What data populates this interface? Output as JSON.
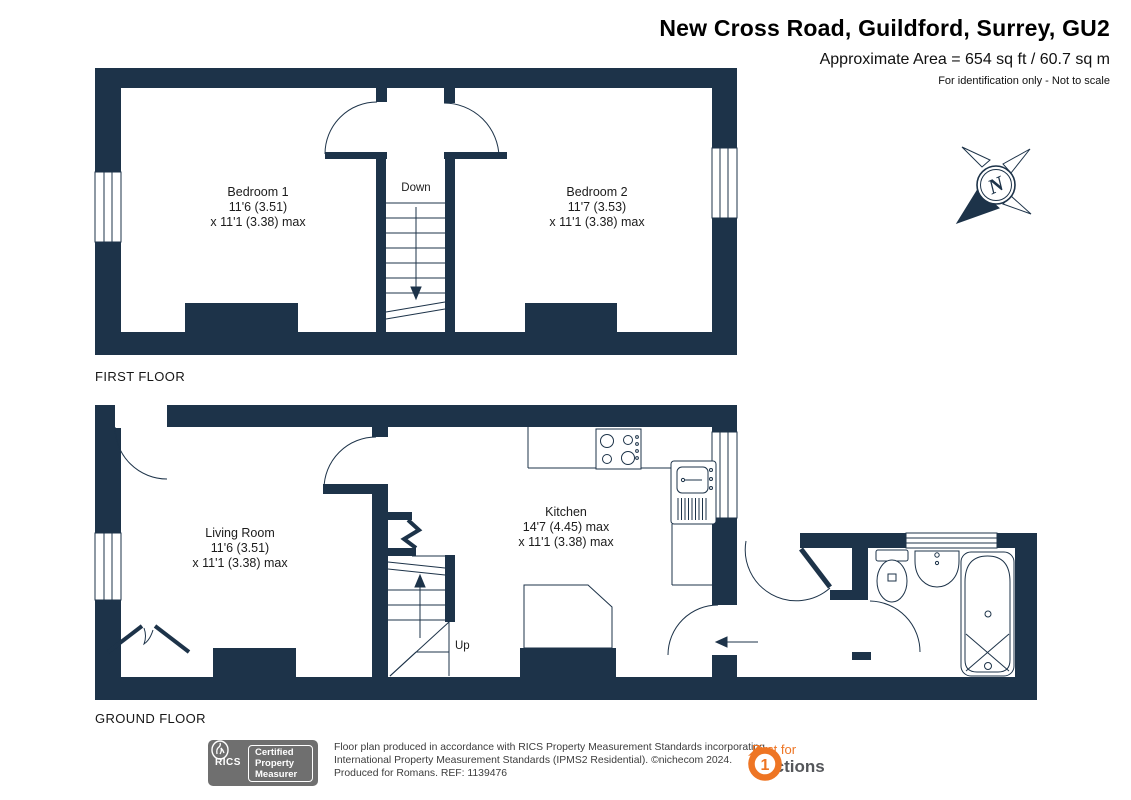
{
  "header": {
    "title": "New Cross Road, Guildford, Surrey, GU2",
    "area": "Approximate Area = 654 sq ft / 60.7 sq m",
    "disclaimer": "For identification only - Not to scale"
  },
  "floors": {
    "first": {
      "label": "FIRST FLOOR"
    },
    "ground": {
      "label": "GROUND FLOOR"
    }
  },
  "rooms": {
    "bedroom1": {
      "name": "Bedroom 1",
      "dim1": "11'6 (3.51)",
      "dim2": "x 11'1 (3.38) max"
    },
    "bedroom2": {
      "name": "Bedroom 2",
      "dim1": "11'7 (3.53)",
      "dim2": "x 11'1 (3.38) max"
    },
    "living": {
      "name": "Living Room",
      "dim1": "11'6 (3.51)",
      "dim2": "x 11'1 (3.38) max"
    },
    "kitchen": {
      "name": "Kitchen",
      "dim1": "14'7 (4.45) max",
      "dim2": "x 11'1 (3.38) max"
    }
  },
  "stairs": {
    "down": "Down",
    "up": "Up"
  },
  "compass": {
    "north": "N"
  },
  "footer": {
    "rics": {
      "org": "RICS",
      "line1": "Certified",
      "line2": "Property",
      "line3": "Measurer"
    },
    "line1": "Floor plan produced in accordance with RICS Property Measurement Standards incorporating",
    "line2": "International Property Measurement Standards (IPMS2 Residential).   ©nichecom 2024.",
    "line3": "Produced for Romans.    REF: 1139476",
    "auctions": {
      "line1": "First for",
      "line2": "Auctions",
      "one": "1"
    }
  },
  "colors": {
    "wall": "#1d3349",
    "accent": "#ee7524",
    "badge_gray": "#6f6f6f"
  }
}
